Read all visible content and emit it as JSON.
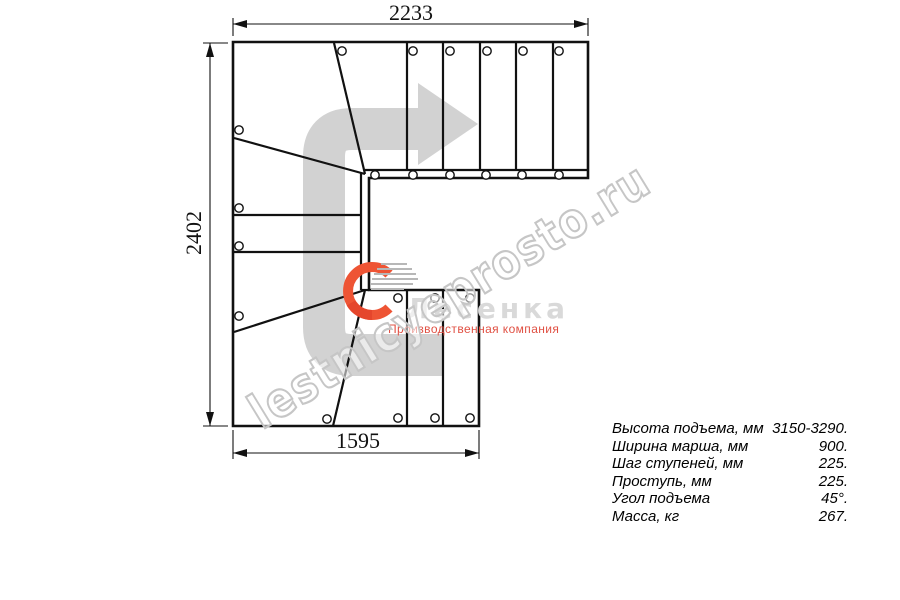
{
  "dimensions": {
    "top": "2233",
    "left": "2402",
    "bottom": "1595"
  },
  "watermark": {
    "text": "lestnicyeprosto.ru"
  },
  "logo": {
    "name": "Лесенка",
    "tagline": "Производственная компания"
  },
  "specs": [
    {
      "label": "Высота подъема, мм",
      "value": "3150-3290."
    },
    {
      "label": "Ширина марша, мм",
      "value": "900."
    },
    {
      "label": "Шаг ступеней, мм",
      "value": "225."
    },
    {
      "label": "Проступь, мм",
      "value": "225."
    },
    {
      "label": "Угол подъема",
      "value": "45°."
    },
    {
      "label": "Масса, кг",
      "value": "267."
    }
  ],
  "colors": {
    "line": "#111111",
    "route_arrow": "#d2d2d2",
    "logo_orange": "#ee5434",
    "logo_accent": "#e5462c",
    "logo_stripe": "#b7b7b7",
    "logo_text": "#d9d9d9",
    "tagline_red": "#e05043",
    "watermark_stroke": "#c6c6c6"
  },
  "drawing": {
    "outline": "M233,42 L588,42 L588,178 L369,178 L369,290 L479,290 L479,426 L233,426 Z",
    "lines": [
      [
        365,
        170,
        588,
        170
      ],
      [
        361,
        172,
        361,
        290
      ],
      [
        361,
        290,
        369,
        290
      ],
      [
        334,
        43,
        365,
        174
      ],
      [
        234,
        138,
        365,
        174
      ],
      [
        234,
        332,
        365,
        290
      ],
      [
        365,
        290,
        333,
        426
      ],
      [
        233,
        215,
        361,
        215
      ],
      [
        233,
        252,
        361,
        252
      ],
      [
        407,
        43,
        407,
        170
      ],
      [
        443,
        43,
        443,
        170
      ],
      [
        480,
        43,
        480,
        170
      ],
      [
        516,
        43,
        516,
        170
      ],
      [
        553,
        43,
        553,
        170
      ],
      [
        407,
        290,
        407,
        426
      ],
      [
        443,
        290,
        443,
        426
      ]
    ],
    "holes": [
      [
        342,
        51
      ],
      [
        413,
        51
      ],
      [
        450,
        51
      ],
      [
        487,
        51
      ],
      [
        523,
        51
      ],
      [
        559,
        51
      ],
      [
        375,
        175
      ],
      [
        413,
        175
      ],
      [
        450,
        175
      ],
      [
        486,
        175
      ],
      [
        522,
        175
      ],
      [
        559,
        175
      ],
      [
        239,
        130
      ],
      [
        239,
        208
      ],
      [
        239,
        246
      ],
      [
        239,
        316
      ],
      [
        327,
        419
      ],
      [
        398,
        298
      ],
      [
        435,
        298
      ],
      [
        470,
        298
      ],
      [
        398,
        418
      ],
      [
        435,
        418
      ],
      [
        470,
        418
      ]
    ],
    "dim": {
      "ext": [
        [
          233,
          36,
          233,
          18
        ],
        [
          588,
          36,
          588,
          18
        ],
        [
          228,
          43,
          203,
          43
        ],
        [
          228,
          426,
          203,
          426
        ],
        [
          233,
          430,
          233,
          459
        ],
        [
          479,
          430,
          479,
          459
        ]
      ],
      "lines": [
        [
          233,
          24,
          588,
          24
        ],
        [
          210,
          43,
          210,
          426
        ],
        [
          233,
          453,
          479,
          453
        ]
      ],
      "arrows": [
        {
          "x": 233,
          "y": 24,
          "dir": "left"
        },
        {
          "x": 588,
          "y": 24,
          "dir": "right"
        },
        {
          "x": 210,
          "y": 43,
          "dir": "up"
        },
        {
          "x": 210,
          "y": 426,
          "dir": "down"
        },
        {
          "x": 233,
          "y": 453,
          "dir": "left"
        },
        {
          "x": 479,
          "y": 453,
          "dir": "right"
        }
      ]
    },
    "route_arrow": {
      "body": "M443,355 H352 Q324,355 324,327 V157 Q324,129 352,129 H418",
      "head": "M418,83 L478,124 L418,165 Z",
      "width": 42
    },
    "logo_icon": {
      "arc": "M389,274 A24,24 0 1 0 389,308",
      "accent_arc": "M351,303 A24,24 0 0 0 372,315",
      "stripes": [
        [
          381,
          264,
          407,
          264
        ],
        [
          377,
          269,
          412,
          269
        ],
        [
          374,
          274,
          416,
          274
        ],
        [
          372,
          279,
          418,
          279
        ],
        [
          371,
          284,
          413,
          284
        ],
        [
          371,
          289,
          404,
          289
        ]
      ]
    }
  }
}
